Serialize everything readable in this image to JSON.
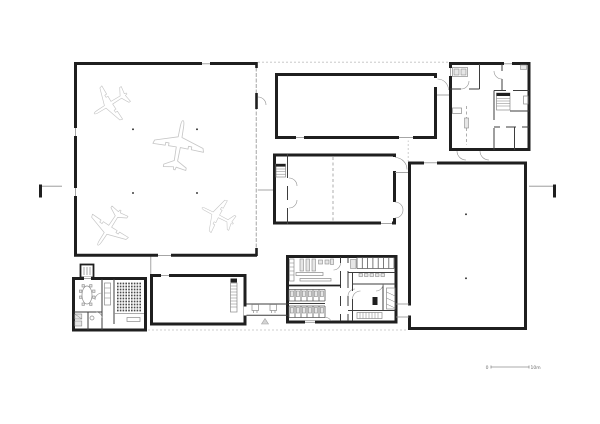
{
  "document": {
    "kind_label": "",
    "scale_bar": {
      "zero_label": "0",
      "end_label": "10m"
    },
    "aircraft_count": 4
  },
  "icons": {
    "aircraft": "airplane-top-view-outline-icon",
    "entrance_marker": "entrance-triangle-icon",
    "section_marker": "section-cut-marker-icon"
  },
  "colors": {
    "paper": "#ffffff",
    "wall": "#1f1f1f",
    "thin": "#3d3d3d",
    "light": "#8f8f8f",
    "dashline": "#c0c0c0",
    "aircraft": "#c6c6c6",
    "furniture": "#8a8a8a"
  }
}
